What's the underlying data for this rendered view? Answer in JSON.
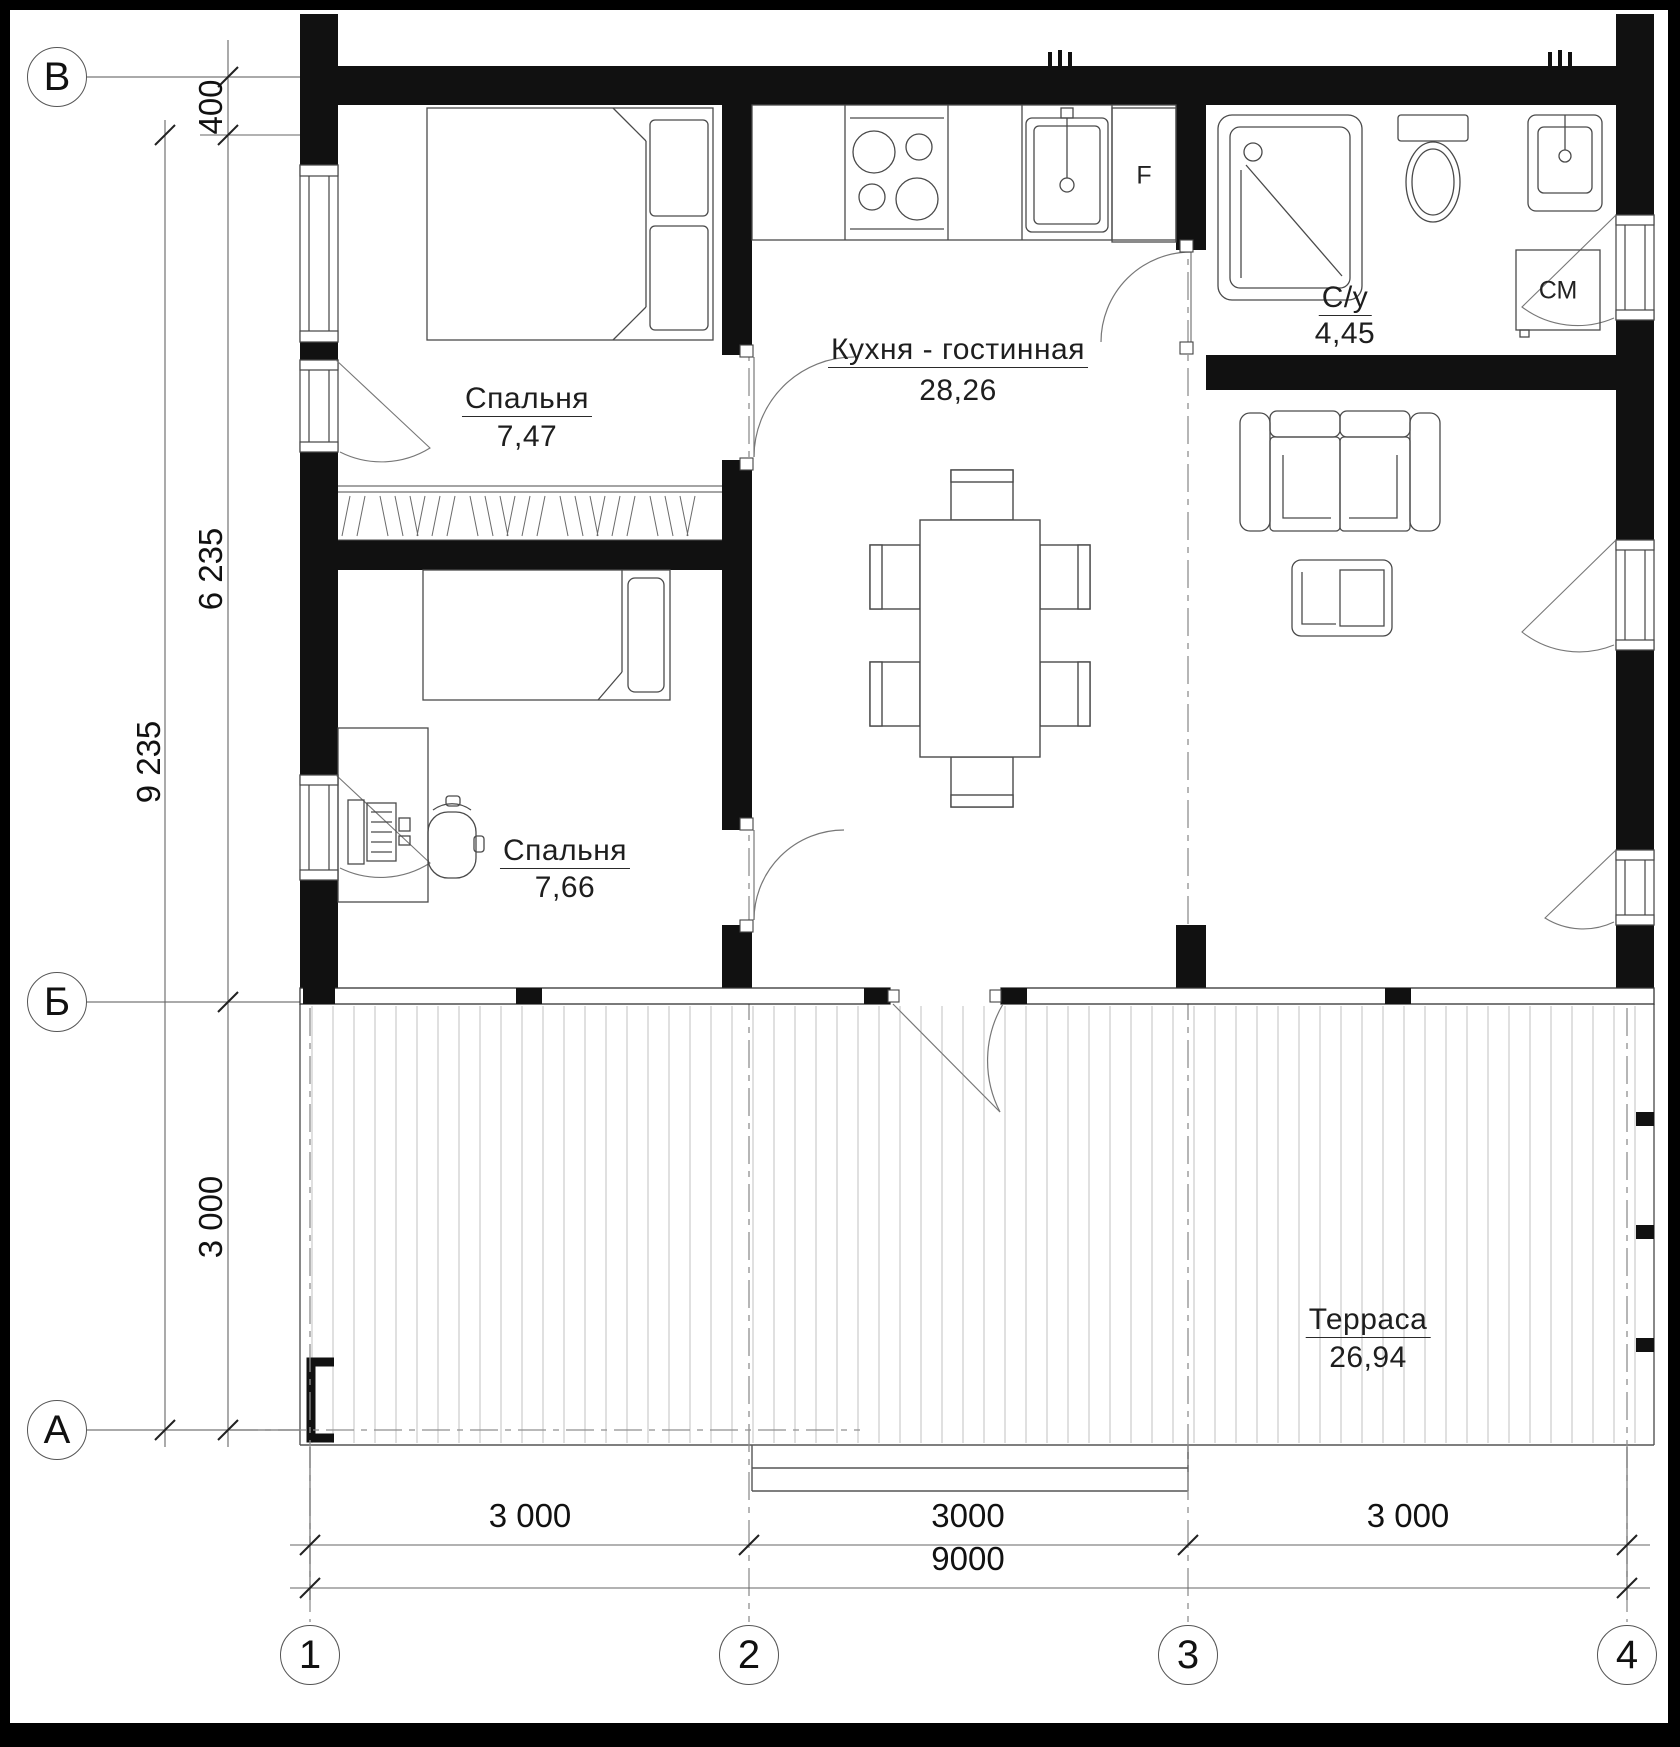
{
  "drawing": {
    "type": "architectural floor plan",
    "axes": {
      "rows": [
        {
          "label": "В"
        },
        {
          "label": "Б"
        },
        {
          "label": "А"
        }
      ],
      "cols": [
        {
          "label": "1"
        },
        {
          "label": "2"
        },
        {
          "label": "3"
        },
        {
          "label": "4"
        }
      ]
    },
    "rooms": [
      {
        "name": "Спальня",
        "area": "7,47"
      },
      {
        "name": "Кухня - гостинная",
        "area": "28,26"
      },
      {
        "name": "С/у",
        "area": "4,45"
      },
      {
        "name": "Спальня",
        "area": "7,66"
      },
      {
        "name": "Терраса",
        "area": "26,94"
      }
    ],
    "dimensions": {
      "left_total": "9 235",
      "left_segments": [
        "400",
        "6 235",
        "3 000"
      ],
      "bottom_segments": [
        "3 000",
        "3000",
        "3 000"
      ],
      "bottom_total": "9000"
    },
    "labels": {
      "fridge": "F",
      "washer": "СМ"
    }
  }
}
